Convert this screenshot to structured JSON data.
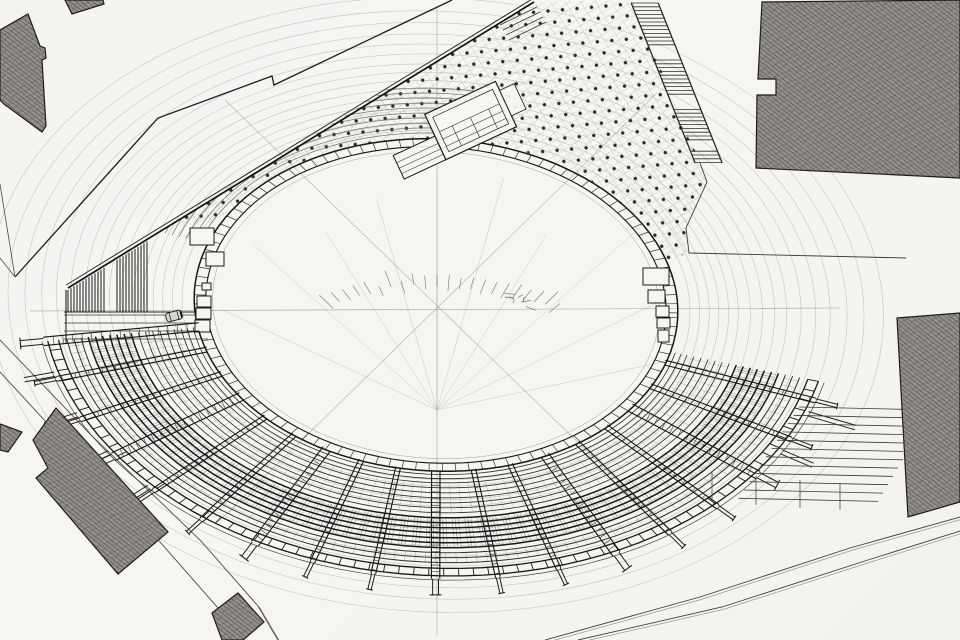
{
  "drawing": {
    "title_hint": "",
    "colors": {
      "paper": "#f6f5f2",
      "ink_dark": "#161616",
      "ink_mid": "#3a3a3a",
      "ink_soft": "#6a6a6a",
      "ink_faint": "#979590",
      "hatch_base": "#96938f",
      "hatch_line": "#45423f"
    },
    "ellipse": {
      "cx": 436,
      "cy": 305,
      "a": 242,
      "b": 166,
      "rotation_deg": 3,
      "band_outer_scale": 1.0,
      "band_inner_scale": 0.952,
      "arena_line_scale": 0.924,
      "brick_tick_step_deg": 3.2,
      "guide_scales": [
        1.05,
        1.09,
        1.13,
        1.17,
        1.21,
        1.25,
        1.3,
        1.35,
        1.4,
        1.45,
        1.51,
        1.57,
        1.63,
        1.7,
        1.77,
        1.85
      ]
    },
    "center_marks": {
      "h_line": [
        30,
        311,
        840,
        308
      ],
      "v_line": [
        437,
        6,
        437,
        636
      ],
      "diag1": [
        225,
        100,
        658,
        520
      ],
      "diag2": [
        655,
        95,
        218,
        522
      ],
      "fan_origin": [
        437,
        410
      ],
      "fan_angles": [
        -155,
        -138,
        -122,
        -106,
        -90,
        -74,
        -58,
        -42,
        -26,
        -12
      ],
      "fan_len": 235,
      "dome_center": [
        437,
        408
      ],
      "dome_r": 200,
      "dome_squash": 0.6,
      "dome_t0": 238,
      "dome_t1": 306,
      "dome_step": 3.2,
      "scribble_at": [
        516,
        300
      ]
    },
    "plaza": {
      "prom_point": [
        174,
        223
      ],
      "band_t0": 205,
      "band_t1": 340,
      "east_edge": [
        [
          689,
          253
        ],
        [
          686,
          228
        ],
        [
          707,
          182
        ],
        [
          700,
          163
        ],
        [
          632,
          0
        ],
        [
          534,
          2
        ]
      ],
      "pattern_angle": -31.5
    },
    "nw_rows": {
      "t0": 197,
      "t1": 283,
      "scales": [
        1.035,
        1.065,
        1.095,
        1.125,
        1.155,
        1.185,
        1.215,
        1.245,
        1.275,
        1.305
      ],
      "clip": [
        [
          56,
          298
        ],
        [
          538,
          -6
        ],
        [
          652,
          244
        ],
        [
          436,
          307
        ]
      ]
    },
    "promenade": {
      "x1": 68,
      "y1": 288,
      "x2": 534,
      "y2": 2,
      "gap": 3.5,
      "steps": [
        [
          500,
          25,
          537,
          7
        ],
        [
          503,
          30,
          540,
          12
        ],
        [
          506,
          35,
          543,
          17
        ],
        [
          509,
          40,
          546,
          22
        ]
      ]
    },
    "boundary_nw": [
      [
        15,
        277
      ],
      [
        158,
        118
      ],
      [
        272,
        76
      ],
      [
        274,
        85
      ],
      [
        452,
        0
      ]
    ],
    "boundary_e": [
      [
        700,
        163
      ],
      [
        707,
        182
      ],
      [
        686,
        228
      ],
      [
        689,
        253
      ],
      [
        906,
        258
      ]
    ],
    "west_roads": [
      [
        0,
        184,
        15,
        277
      ],
      [
        0,
        258,
        15,
        277
      ]
    ],
    "sw_road": {
      "edge1": [
        [
          0,
          340
        ],
        [
          92,
          436
        ],
        [
          200,
          540
        ],
        [
          258,
          606
        ],
        [
          278,
          640
        ]
      ],
      "edge2": [
        [
          0,
          372
        ],
        [
          70,
          448
        ],
        [
          160,
          542
        ],
        [
          218,
          608
        ],
        [
          236,
          640
        ]
      ]
    },
    "se_road": {
      "edge1": [
        [
          545,
          640
        ],
        [
          700,
          597
        ],
        [
          850,
          548
        ],
        [
          960,
          517
        ]
      ],
      "edge2": [
        [
          578,
          640
        ],
        [
          722,
          607
        ],
        [
          868,
          560
        ],
        [
          960,
          531
        ]
      ]
    },
    "stairs_ne": {
      "rail_x0": 630,
      "rail_slope": 0.4,
      "width": 27,
      "y0": 3,
      "y1": 163,
      "step": 3.8,
      "landings": [
        [
          48,
          58
        ],
        [
          96,
          108
        ],
        [
          142,
          150
        ]
      ]
    },
    "stairs_se": {
      "n": 12,
      "y0": 407,
      "dy": 8.3,
      "xl0": 799,
      "dxl": 5.5,
      "xr_hi": 903,
      "tilt": 0.022,
      "dividers": [
        [
          712,
          472,
          712,
          502
        ],
        [
          756,
          476,
          756,
          505
        ],
        [
          800,
          480,
          800,
          508
        ],
        [
          840,
          483,
          840,
          510
        ]
      ]
    },
    "stand": {
      "t0": 12,
      "t1": 168,
      "walkway": [
        1.02,
        1.045
      ],
      "rows_inner": [
        1.07,
        1.1,
        1.13,
        1.16,
        1.19,
        1.22,
        1.25
      ],
      "rows_dense": [
        1.28,
        1.31,
        1.34,
        1.37,
        1.4,
        1.43,
        1.46
      ],
      "rows_outer": [
        1.49,
        1.52,
        1.55
      ],
      "gallery": [
        1.585,
        1.63
      ],
      "rim": 1.655,
      "gallery_tick_step": 2.2,
      "hatch_step": 1.15,
      "ticksA": [
        1.075,
        1.245,
        2.0
      ],
      "ticksC": [
        1.49,
        1.55,
        1.6
      ],
      "beam_angles": [
        16,
        25,
        34,
        43,
        52,
        61,
        70,
        79,
        88,
        97,
        106,
        115,
        124,
        133,
        142,
        151,
        160,
        168
      ],
      "wide_beams": [
        34,
        61,
        88,
        115,
        142,
        168
      ],
      "beam_s0": 0.995,
      "beam_s1": 1.648,
      "stub_s1": 1.745,
      "tails": [
        [
          134,
          1.82
        ],
        [
          143,
          1.82
        ],
        [
          152,
          1.8
        ],
        [
          161,
          1.78
        ],
        [
          19,
          1.86
        ],
        [
          28,
          1.8
        ]
      ]
    },
    "terrace_w": {
      "comb_groups": [
        [
          68,
          104
        ],
        [
          117,
          149
        ]
      ],
      "comb_step": 3,
      "comb_bottom": 312,
      "rails": [
        [
          64,
          312,
          206,
          312
        ],
        [
          66,
          290,
          66,
          344
        ]
      ],
      "steps_y": [
        315,
        323,
        331,
        339
      ],
      "steps_x": [
        64,
        208
      ]
    },
    "gates_west": [
      [
        190,
        228,
        24,
        17
      ],
      [
        206,
        252,
        18,
        14
      ],
      [
        202,
        283,
        9,
        7
      ],
      [
        197,
        296,
        14,
        11
      ],
      [
        196,
        308,
        15,
        11
      ],
      [
        195,
        320,
        15,
        12
      ]
    ],
    "gates_east": [
      [
        643,
        268,
        26,
        17
      ],
      [
        648,
        290,
        17,
        13
      ],
      [
        656,
        306,
        13,
        11
      ],
      [
        657,
        318,
        13,
        10
      ],
      [
        658,
        330,
        11,
        12
      ]
    ],
    "stage_structure": {
      "x": 472,
      "y": 121,
      "rot": -25,
      "outer": [
        -40,
        -26,
        78,
        50
      ],
      "inner": [
        -34,
        -20,
        66,
        38
      ],
      "h_lines": [
        -4,
        4,
        12
      ],
      "v_lines": [
        -20,
        0,
        20
      ],
      "annex": [
        -86,
        -2,
        46,
        26
      ],
      "annex_lines": [
        6,
        12,
        18
      ],
      "right_annex": [
        38,
        -16,
        16,
        28
      ]
    },
    "car": {
      "x": 174,
      "y": 316,
      "rot": -15,
      "w": 16,
      "h": 9
    },
    "buildings": {
      "top_small": [
        [
          65,
          0
        ],
        [
          103,
          0
        ],
        [
          104,
          4
        ],
        [
          72,
          14
        ]
      ],
      "top_left_L": [
        [
          28,
          14
        ],
        [
          40,
          46
        ],
        [
          45,
          48
        ],
        [
          46,
          58
        ],
        [
          42,
          60
        ],
        [
          46,
          126
        ],
        [
          42,
          132
        ],
        [
          4,
          104
        ],
        [
          0,
          100
        ],
        [
          0,
          30
        ]
      ],
      "top_right": [
        [
          762,
          2
        ],
        [
          960,
          0
        ],
        [
          960,
          178
        ],
        [
          756,
          168
        ],
        [
          757,
          95
        ],
        [
          776,
          95
        ],
        [
          776,
          79
        ],
        [
          758,
          79
        ]
      ],
      "mid_right": [
        [
          897,
          318
        ],
        [
          960,
          313
        ],
        [
          960,
          502
        ],
        [
          908,
          517
        ]
      ],
      "sw_main": [
        [
          56,
          408
        ],
        [
          33,
          440
        ],
        [
          48,
          468
        ],
        [
          36,
          478
        ],
        [
          118,
          574
        ],
        [
          168,
          532
        ]
      ],
      "sw_edge": [
        [
          0,
          424
        ],
        [
          22,
          432
        ],
        [
          8,
          452
        ],
        [
          0,
          450
        ]
      ],
      "diamond": [
        [
          212,
          613
        ],
        [
          238,
          593
        ],
        [
          264,
          622
        ],
        [
          243,
          640
        ],
        [
          222,
          640
        ]
      ]
    }
  }
}
